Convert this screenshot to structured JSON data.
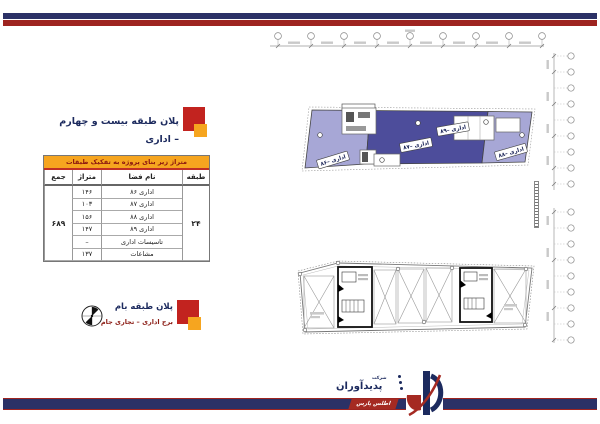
{
  "colors": {
    "top_bar_navy": "#2b3166",
    "top_bar_red": "#9e2420",
    "table_header_orange": "#f6a51f",
    "plan_light_purple": "#a7a7d6",
    "plan_dark_indigo": "#4d4d9b",
    "title_navy": "#1c2a5e",
    "maroon": "#8a1a12"
  },
  "office_section": {
    "title": "پلان طبقه بیست و چهارم – اداری",
    "table": {
      "title": "متراژ زیر بنای پروژه به تفکیک طبقات",
      "col_floor": "طبقه",
      "col_space": "نام فضا",
      "col_area": "متراژ",
      "col_total": "جمع",
      "floor": "۲۴",
      "total": "۶۸۹",
      "rows": [
        {
          "name": "اداری ۸۶",
          "area": "۱۴۶"
        },
        {
          "name": "اداری ۸۷",
          "area": "۱۰۳"
        },
        {
          "name": "اداری ۸۸",
          "area": "۱۵۶"
        },
        {
          "name": "اداری ۸۹",
          "area": "۱۴۷"
        },
        {
          "name": "تاسیسات اداری",
          "area": "–"
        },
        {
          "name": "مشاعات",
          "area": "۱۳۷"
        }
      ]
    }
  },
  "roof_section": {
    "title": "پلان طبقه بام",
    "subtitle": "برج اداری – تجاری جام"
  },
  "plan24": {
    "labels": {
      "unit86": "اداری –۸۶",
      "unit87": "اداری –۸۷",
      "unit88": "اداری –۸۸",
      "unit89": "اداری –۸۹"
    }
  },
  "logo": {
    "prefix": "شرکت",
    "name": "پدیدآوران",
    "subname": "اطلس پارس"
  }
}
